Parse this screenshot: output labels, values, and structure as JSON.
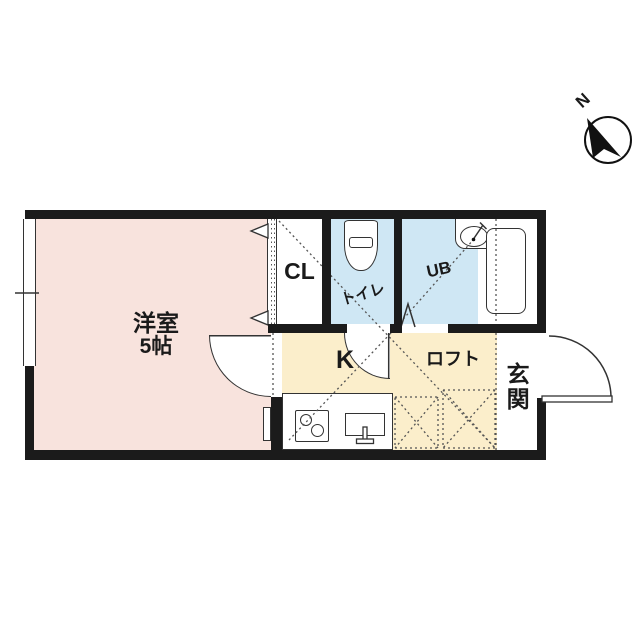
{
  "plan": {
    "rooms": {
      "main_room": {
        "name": "洋室",
        "size": "5帖"
      },
      "closet": {
        "label": "CL"
      },
      "toilet": {
        "label": "トイレ"
      },
      "bath": {
        "label": "UB"
      },
      "kitchen": {
        "label": "K"
      },
      "loft": {
        "label": "ロフト"
      },
      "entrance": {
        "label": "玄関"
      }
    },
    "compass": {
      "north_label": "N"
    }
  },
  "colors": {
    "room": "#f8e3dd",
    "wet": "#cfe7f4",
    "kitchen": "#fbeecb",
    "wall": "#1b1b1b",
    "outline": "#333333",
    "dots": "#555555",
    "text": "#1a1a1a"
  }
}
